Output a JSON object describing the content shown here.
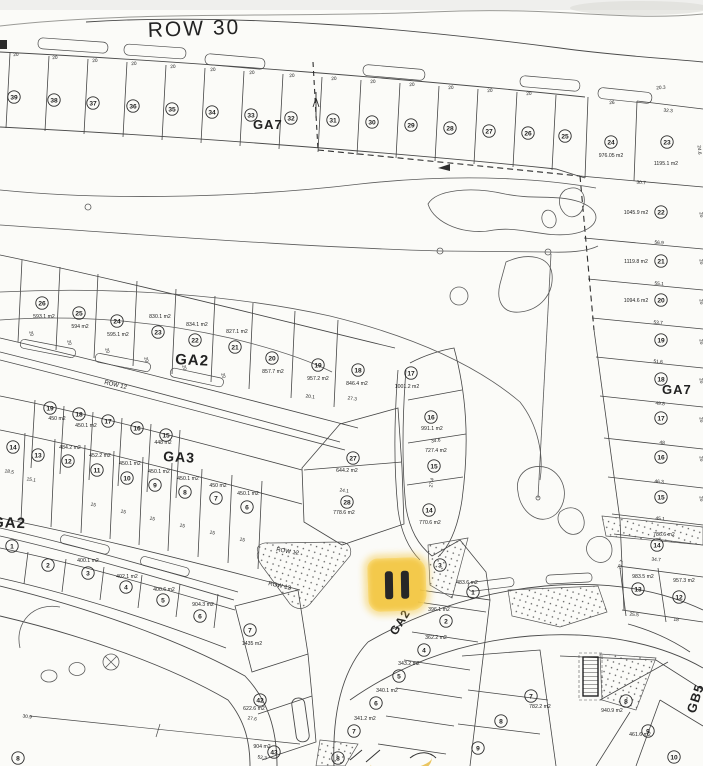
{
  "map": {
    "colors": {
      "paper": "#fbfbf8",
      "ink": "#3a3a3a",
      "highlight": "#f3c53d",
      "marker_bar": "#161616"
    },
    "marker": {
      "type": "pause-highlight",
      "bars": 2
    },
    "region_labels": [
      {
        "text": "ROW 30",
        "x": 148,
        "y": 37,
        "size": 21,
        "rot": -2,
        "bold": false,
        "ls": 2
      },
      {
        "text": "GA7",
        "x": 253,
        "y": 129,
        "size": 13,
        "rot": 0,
        "bold": true,
        "ls": 1
      },
      {
        "text": "GA7",
        "x": 662,
        "y": 394,
        "size": 13,
        "rot": 0,
        "bold": true,
        "ls": 1
      },
      {
        "text": "GA2",
        "x": 175,
        "y": 364,
        "size": 15,
        "rot": 3,
        "bold": true,
        "ls": 1
      },
      {
        "text": "GA3",
        "x": 163,
        "y": 461,
        "size": 14,
        "rot": 3,
        "bold": true,
        "ls": 1
      },
      {
        "text": "GA2",
        "x": -8,
        "y": 527,
        "size": 15,
        "rot": 2,
        "bold": true,
        "ls": 1
      },
      {
        "text": "GA2",
        "x": 396,
        "y": 636,
        "size": 12,
        "rot": -58,
        "bold": true,
        "ls": 1
      },
      {
        "text": "GB5",
        "x": 695,
        "y": 714,
        "size": 13,
        "rot": -72,
        "bold": true,
        "ls": 1
      },
      {
        "text": "ROW 12",
        "x": 104,
        "y": 384,
        "size": 6,
        "rot": 13,
        "bold": false,
        "ls": 0
      },
      {
        "text": "ROW 12",
        "x": 276,
        "y": 551,
        "size": 6,
        "rot": 10,
        "bold": false,
        "ls": 0
      },
      {
        "text": "ROW 12",
        "x": 268,
        "y": 585,
        "size": 6,
        "rot": 12,
        "bold": false,
        "ls": 0
      }
    ],
    "lot_numbers_nxy": [
      [
        "39",
        14,
        97
      ],
      [
        "38",
        54,
        100
      ],
      [
        "37",
        93,
        103
      ],
      [
        "36",
        133,
        106
      ],
      [
        "35",
        172,
        109
      ],
      [
        "34",
        212,
        112
      ],
      [
        "33",
        251,
        115
      ],
      [
        "32",
        291,
        118
      ],
      [
        "31",
        333,
        120
      ],
      [
        "30",
        372,
        122
      ],
      [
        "29",
        411,
        125
      ],
      [
        "28",
        450,
        128
      ],
      [
        "27",
        489,
        131
      ],
      [
        "26",
        528,
        133
      ],
      [
        "25",
        565,
        136
      ],
      [
        "24",
        611,
        142
      ],
      [
        "23",
        667,
        142
      ],
      [
        "22",
        661,
        212
      ],
      [
        "21",
        661,
        261
      ],
      [
        "20",
        661,
        300
      ],
      [
        "19",
        661,
        340
      ],
      [
        "18",
        661,
        379
      ],
      [
        "17",
        661,
        418
      ],
      [
        "16",
        661,
        457
      ],
      [
        "15",
        661,
        497
      ],
      [
        "14",
        657,
        545
      ],
      [
        "13",
        638,
        589
      ],
      [
        "12",
        679,
        597
      ],
      [
        "26",
        42,
        303
      ],
      [
        "25",
        79,
        313
      ],
      [
        "24",
        117,
        321
      ],
      [
        "23",
        158,
        332
      ],
      [
        "22",
        195,
        340
      ],
      [
        "21",
        235,
        347
      ],
      [
        "20",
        272,
        358
      ],
      [
        "19",
        318,
        365
      ],
      [
        "18",
        358,
        370
      ],
      [
        "17",
        411,
        373
      ],
      [
        "16",
        431,
        417
      ],
      [
        "15",
        434,
        466
      ],
      [
        "14",
        429,
        510
      ],
      [
        "27",
        353,
        458
      ],
      [
        "28",
        347,
        502
      ],
      [
        "19",
        50,
        408
      ],
      [
        "18",
        79,
        414
      ],
      [
        "17",
        108,
        421
      ],
      [
        "16",
        137,
        428
      ],
      [
        "15",
        166,
        435
      ],
      [
        "14",
        13,
        447
      ],
      [
        "13",
        38,
        455
      ],
      [
        "12",
        68,
        461
      ],
      [
        "11",
        97,
        470
      ],
      [
        "10",
        127,
        478
      ],
      [
        "9",
        155,
        485
      ],
      [
        "8",
        185,
        492
      ],
      [
        "7",
        216,
        498
      ],
      [
        "6",
        247,
        507
      ],
      [
        "1",
        12,
        546
      ],
      [
        "2",
        48,
        565
      ],
      [
        "3",
        88,
        573
      ],
      [
        "4",
        126,
        587
      ],
      [
        "5",
        163,
        600
      ],
      [
        "6",
        200,
        616
      ],
      [
        "7",
        250,
        630
      ],
      [
        "42",
        260,
        700
      ],
      [
        "43",
        274,
        752
      ],
      [
        "3",
        440,
        565
      ],
      [
        "1",
        473,
        592
      ],
      [
        "2",
        446,
        621
      ],
      [
        "4",
        424,
        650
      ],
      [
        "5",
        399,
        676
      ],
      [
        "6",
        376,
        703
      ],
      [
        "7",
        354,
        731
      ],
      [
        "8",
        338,
        758
      ],
      [
        "7",
        531,
        696
      ],
      [
        "8",
        501,
        721
      ],
      [
        "9",
        478,
        748
      ],
      [
        "8",
        626,
        701
      ],
      [
        "9",
        648,
        731
      ],
      [
        "10",
        674,
        757
      ],
      [
        "8",
        18,
        758
      ]
    ],
    "area_labels_txy": [
      [
        "976.05 m2",
        611,
        157
      ],
      [
        "1195.1 m2",
        666,
        165
      ],
      [
        "1045.9 m2",
        636,
        214
      ],
      [
        "1119.8 m2",
        636,
        263
      ],
      [
        "1094.6 m2",
        636,
        302
      ],
      [
        "786.6 m2",
        664,
        536
      ],
      [
        "983.5 m2",
        643,
        578
      ],
      [
        "957.3 m2",
        684,
        582
      ],
      [
        "593.1 m2",
        44,
        318
      ],
      [
        "594 m2",
        80,
        328
      ],
      [
        "595.1 m2",
        118,
        336
      ],
      [
        "830.1 m2",
        160,
        318
      ],
      [
        "834.1 m2",
        197,
        326
      ],
      [
        "827.1 m2",
        237,
        333
      ],
      [
        "857.7 m2",
        273,
        373
      ],
      [
        "957.2 m2",
        318,
        380
      ],
      [
        "846.4 m2",
        357,
        385
      ],
      [
        "1001.2 m2",
        407,
        388
      ],
      [
        "991.1 m2",
        432,
        430
      ],
      [
        "727.4 m2",
        436,
        452
      ],
      [
        "770.6 m2",
        430,
        524
      ],
      [
        "644.2 m2",
        347,
        472
      ],
      [
        "778.6 m2",
        344,
        514
      ],
      [
        "448 m2",
        163,
        444
      ],
      [
        "450 m2",
        57,
        420
      ],
      [
        "450.1 m2",
        86,
        427
      ],
      [
        "484.2 m2",
        70,
        449
      ],
      [
        "452.2 m2",
        100,
        457
      ],
      [
        "450.1 m2",
        130,
        465
      ],
      [
        "450.1 m2",
        159,
        473
      ],
      [
        "450.1 m2",
        188,
        480
      ],
      [
        "450 m2",
        218,
        487
      ],
      [
        "450.1 m2",
        248,
        495
      ],
      [
        "400.1 m2",
        88,
        562
      ],
      [
        "402.1 m2",
        127,
        578
      ],
      [
        "400.6 m2",
        164,
        591
      ],
      [
        "904.3 m2",
        203,
        606
      ],
      [
        "1435 m2",
        252,
        645
      ],
      [
        "622.6 m2",
        254,
        710
      ],
      [
        "904 m2",
        262,
        748
      ],
      [
        "483.6 m2",
        467,
        584
      ],
      [
        "396.1 m2",
        439,
        611
      ],
      [
        "362.2 m2",
        436,
        639
      ],
      [
        "343.2 m2",
        409,
        665
      ],
      [
        "340.1 m2",
        387,
        692
      ],
      [
        "341.2 m2",
        365,
        720
      ],
      [
        "782.2 m2",
        540,
        708
      ],
      [
        "940.9 m2",
        612,
        712
      ],
      [
        "461.6 m2",
        640,
        736
      ]
    ],
    "dim_labels_txyr": [
      [
        "20",
        16,
        56,
        -4
      ],
      [
        "20",
        55,
        59,
        -4
      ],
      [
        "20",
        95,
        62,
        -4
      ],
      [
        "20",
        134,
        65,
        -4
      ],
      [
        "20",
        173,
        68,
        -4
      ],
      [
        "20",
        213,
        71,
        -4
      ],
      [
        "20",
        252,
        74,
        -4
      ],
      [
        "20",
        292,
        77,
        -4
      ],
      [
        "20",
        334,
        80,
        -4
      ],
      [
        "20",
        373,
        83,
        -4
      ],
      [
        "20",
        412,
        86,
        -4
      ],
      [
        "20",
        451,
        89,
        -4
      ],
      [
        "20",
        490,
        92,
        -4
      ],
      [
        "20",
        529,
        95,
        -4
      ],
      [
        "26",
        612,
        104,
        -4
      ],
      [
        "20.3",
        661,
        89,
        -4
      ],
      [
        "32.3",
        668,
        112,
        5
      ],
      [
        "24.6",
        698,
        150,
        85
      ],
      [
        "30.7",
        641,
        184,
        5
      ],
      [
        "56.9",
        659,
        244,
        5
      ],
      [
        "55.1",
        659,
        285,
        5
      ],
      [
        "53.7",
        658,
        324,
        5
      ],
      [
        "51.6",
        658,
        363,
        5
      ],
      [
        "49.8",
        660,
        405,
        5
      ],
      [
        "48",
        662,
        444,
        5
      ],
      [
        "46.3",
        659,
        483,
        5
      ],
      [
        "45.1",
        660,
        520,
        5
      ],
      [
        "34.7",
        656,
        561,
        5
      ],
      [
        "25.5",
        634,
        616,
        5
      ],
      [
        "18",
        676,
        621,
        5
      ],
      [
        "21.7",
        622,
        565,
        -70
      ],
      [
        "20",
        700,
        215,
        80
      ],
      [
        "20",
        700,
        262,
        80
      ],
      [
        "20",
        700,
        302,
        80
      ],
      [
        "20",
        700,
        342,
        80
      ],
      [
        "20",
        700,
        381,
        80
      ],
      [
        "20",
        700,
        420,
        80
      ],
      [
        "20",
        700,
        459,
        80
      ],
      [
        "20",
        700,
        499,
        80
      ],
      [
        "20",
        30,
        334,
        72
      ],
      [
        "20",
        68,
        343,
        72
      ],
      [
        "20",
        106,
        351,
        72
      ],
      [
        "20",
        145,
        360,
        72
      ],
      [
        "20",
        183,
        368,
        72
      ],
      [
        "20",
        222,
        376,
        72
      ],
      [
        "20.1",
        310,
        398,
        8
      ],
      [
        "27.3",
        352,
        400,
        8
      ],
      [
        "34.6",
        436,
        442,
        -8
      ],
      [
        "27.4",
        433,
        483,
        -80
      ],
      [
        "24.1",
        344,
        492,
        8
      ],
      [
        "18.5",
        9,
        473,
        10
      ],
      [
        "15.1",
        31,
        481,
        10
      ],
      [
        "15",
        93,
        506,
        12
      ],
      [
        "15",
        123,
        513,
        12
      ],
      [
        "15",
        152,
        520,
        12
      ],
      [
        "15",
        182,
        527,
        12
      ],
      [
        "15",
        212,
        534,
        12
      ],
      [
        "15",
        242,
        541,
        12
      ],
      [
        "30.9",
        27,
        718,
        8
      ],
      [
        "27.6",
        252,
        720,
        8
      ],
      [
        "52.3",
        262,
        759,
        8
      ]
    ]
  }
}
